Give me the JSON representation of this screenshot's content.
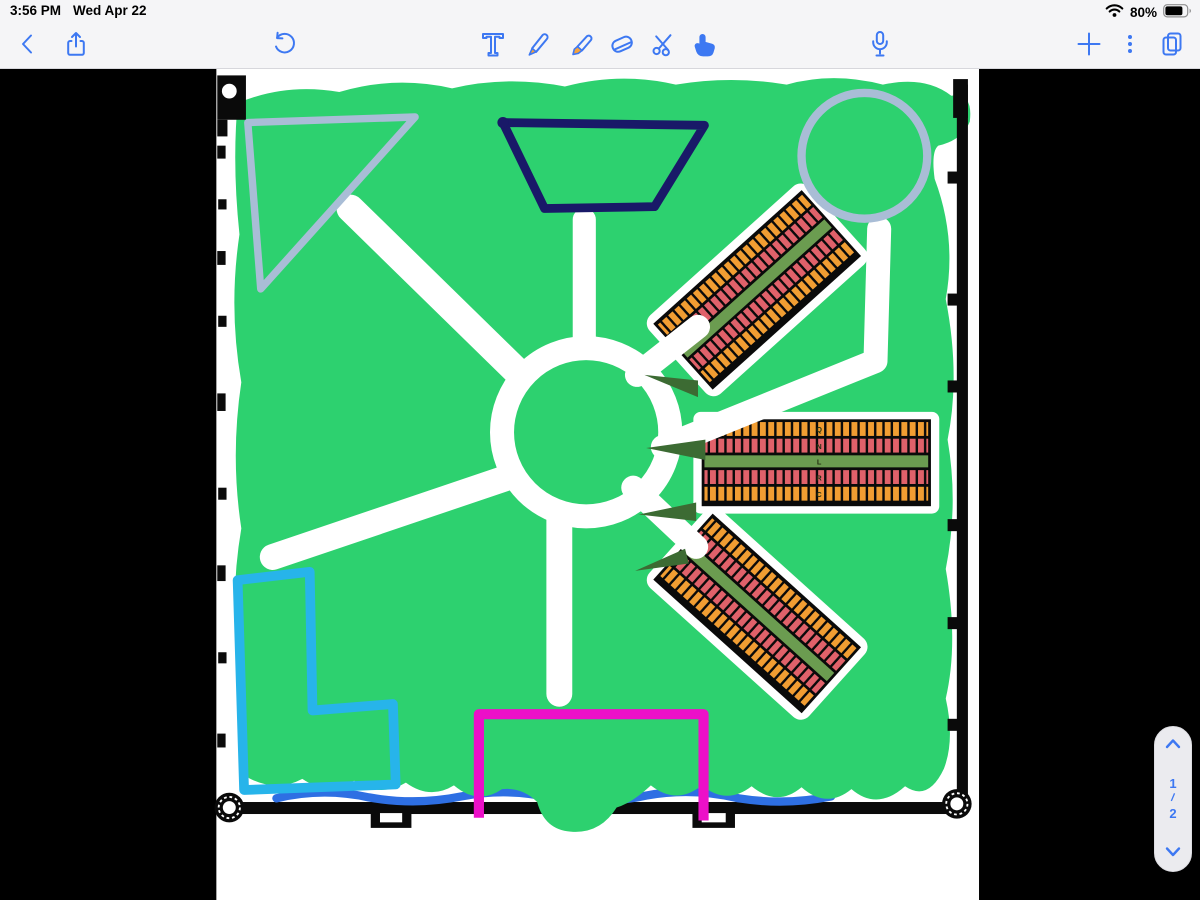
{
  "status_bar": {
    "time": "3:56 PM",
    "date": "Wed Apr 22",
    "battery_percent": "80%",
    "icons": {
      "wifi": "wifi-icon",
      "battery": "battery-icon"
    }
  },
  "toolbar": {
    "selected_tool": "finger-select",
    "buttons": [
      {
        "name": "back",
        "icon": "chevron-left-icon"
      },
      {
        "name": "share",
        "icon": "share-icon"
      },
      {
        "name": "undo",
        "icon": "undo-icon"
      },
      {
        "name": "text-tool",
        "icon": "text-tool-icon"
      },
      {
        "name": "pen-tool",
        "icon": "pen-icon"
      },
      {
        "name": "highlighter-tool",
        "icon": "highlighter-icon"
      },
      {
        "name": "eraser-tool",
        "icon": "eraser-icon"
      },
      {
        "name": "scissors-tool",
        "icon": "scissors-icon"
      },
      {
        "name": "finger-select",
        "icon": "finger-select-icon"
      },
      {
        "name": "record-audio",
        "icon": "microphone-icon"
      },
      {
        "name": "add",
        "icon": "plus-icon"
      },
      {
        "name": "more",
        "icon": "ellipsis-vertical-icon"
      },
      {
        "name": "page-overview",
        "icon": "pages-icon"
      }
    ]
  },
  "page_nav": {
    "up_icon": "chevron-up-icon",
    "current": "1",
    "separator": "/",
    "total": "2",
    "down_icon": "chevron-down-icon"
  },
  "canvas": {
    "colors": {
      "toolbar_blue": "#3d78f2",
      "tool_tip_orange": "#f5a23c",
      "marker_green": "#2dd16f",
      "shape_gray": "#a9bdd6",
      "shape_navy": "#191968",
      "shape_cyan": "#27b4ea",
      "shape_magenta": "#ec10c8",
      "road_white": "#ffffff",
      "plot_orange": "#f19d32",
      "plot_red": "#e0616a",
      "plot_path_green": "#6b9c50",
      "tree_green": "#3c6b33",
      "water_blue": "#2e6fe3",
      "ink_black": "#0a0a0a",
      "page_white": "#ffffff"
    },
    "plot_labels": {
      "middle": [
        "Q",
        "N",
        "L",
        "R",
        "C"
      ]
    }
  }
}
